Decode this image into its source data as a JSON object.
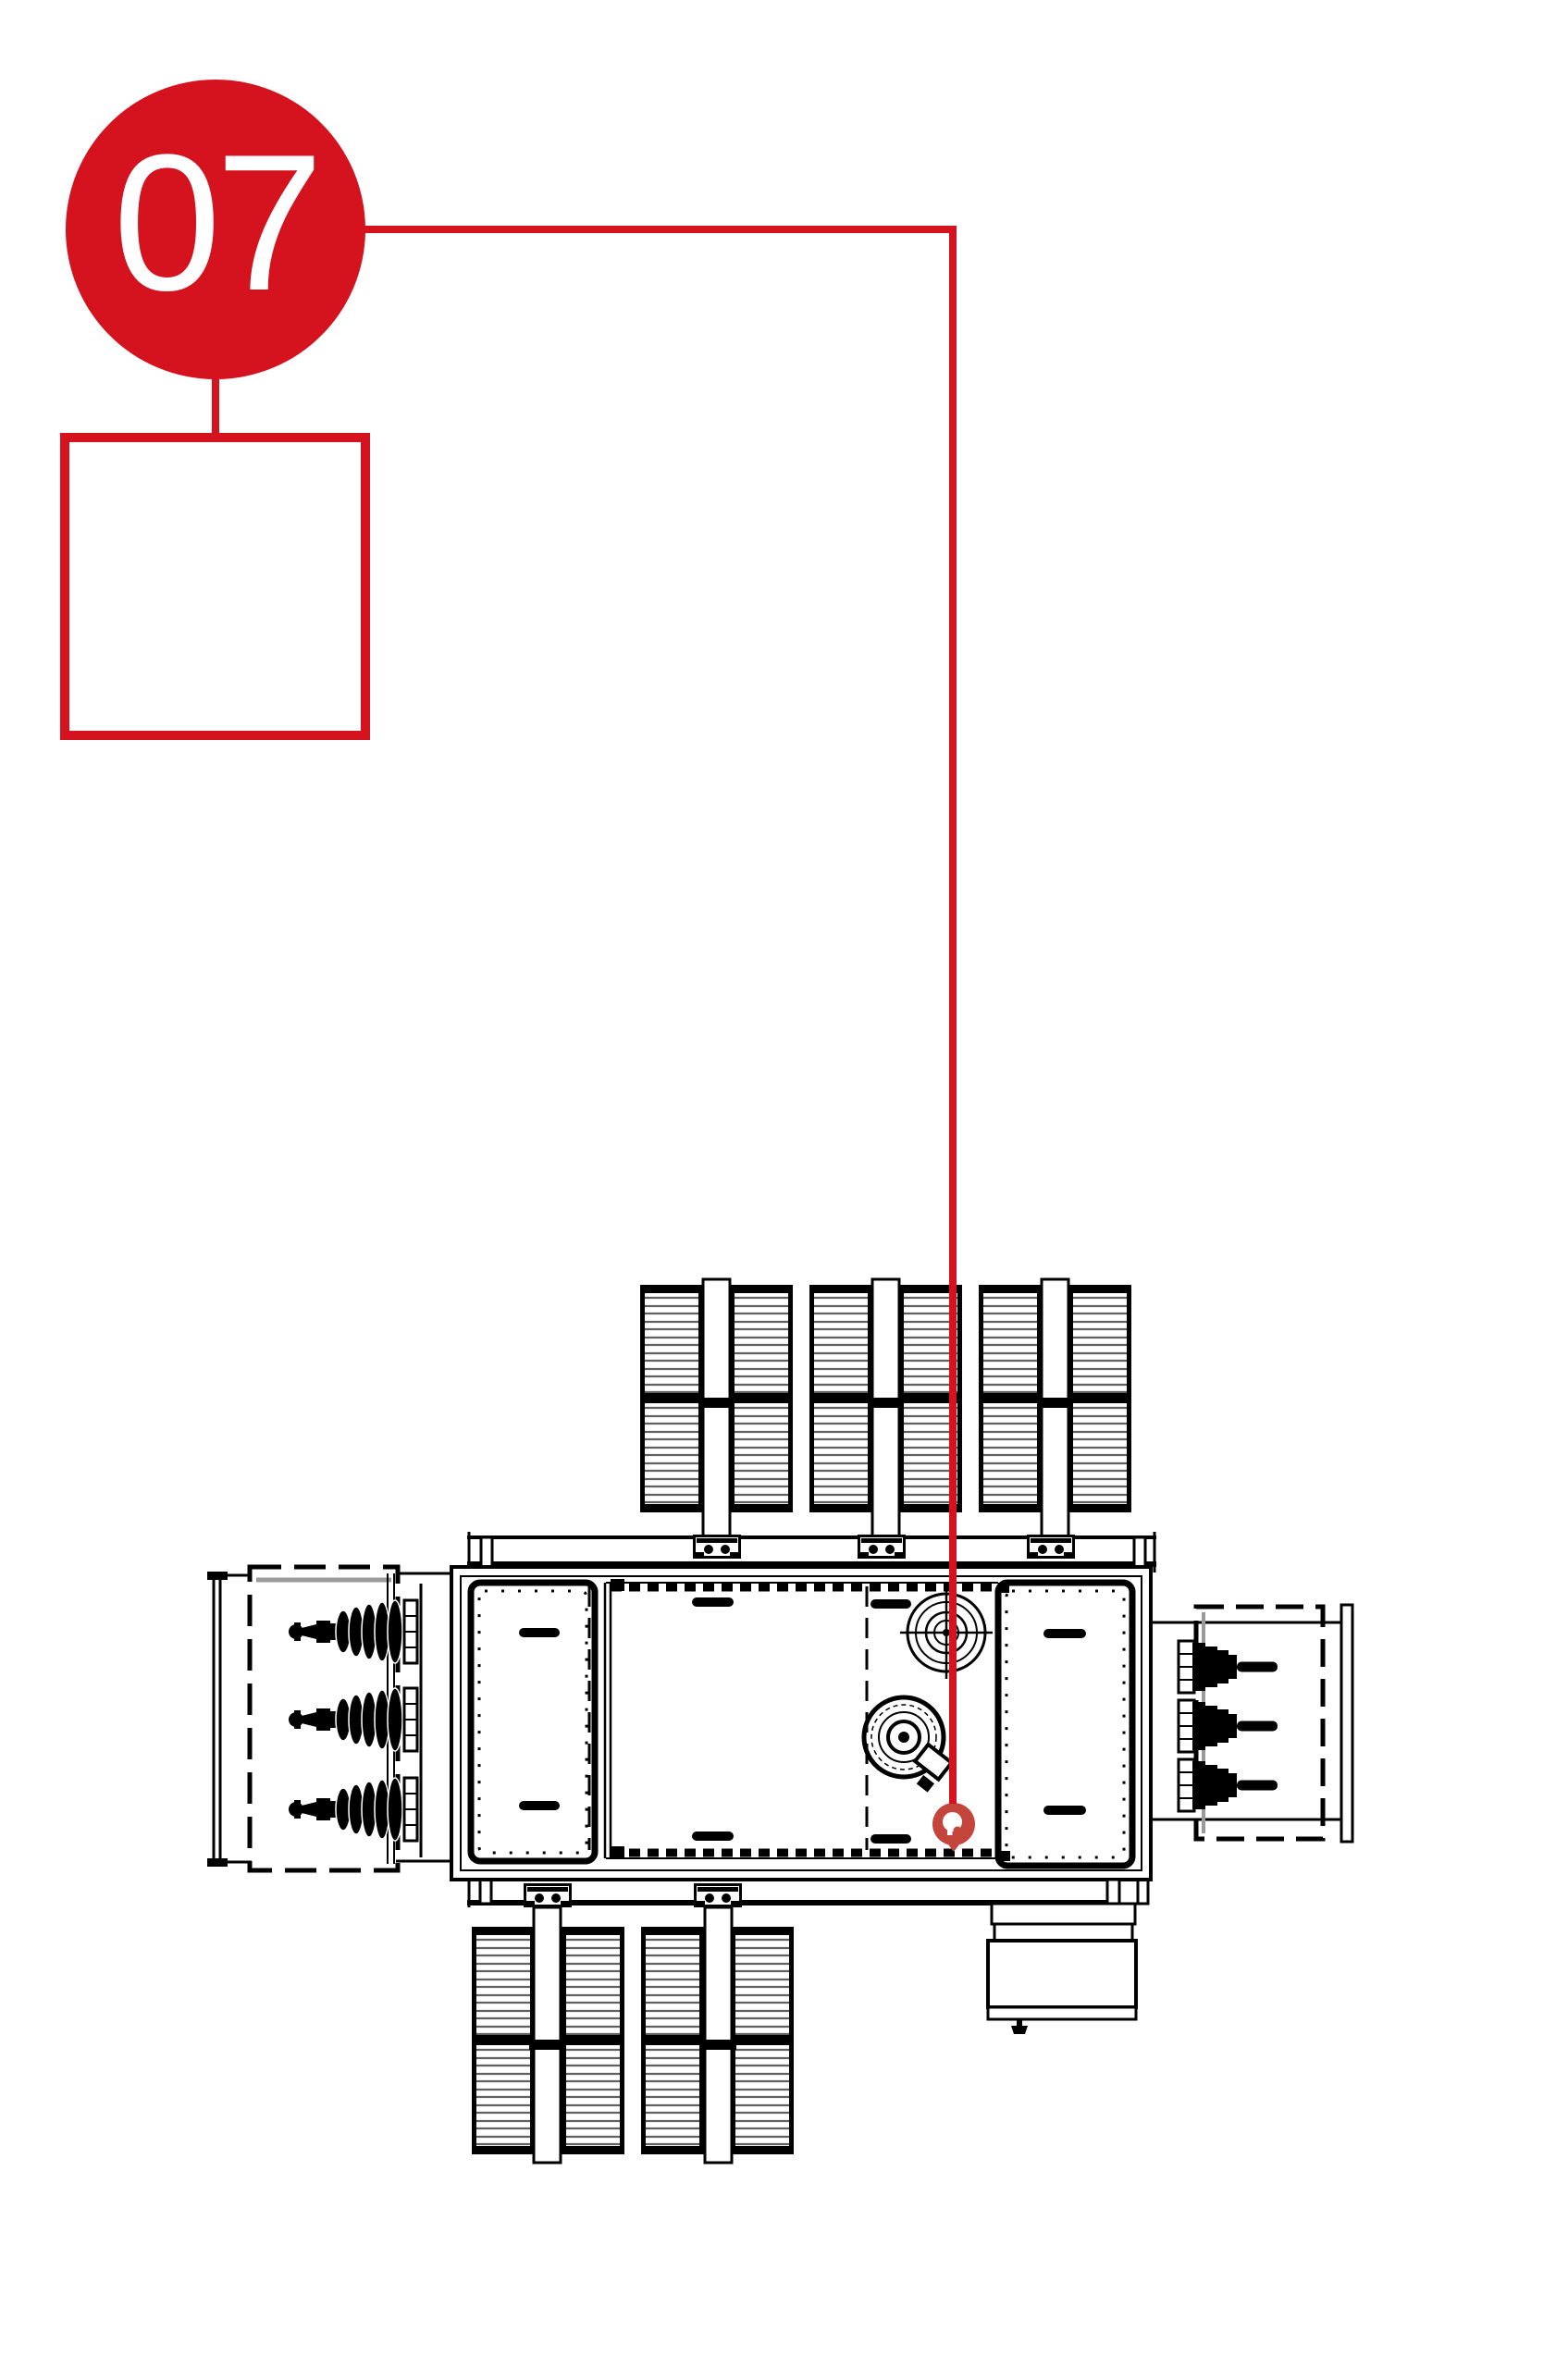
{
  "callout": {
    "number": "07"
  },
  "reference_box": {
    "icon": "location-pin-icon"
  },
  "target_marker": {
    "icon": "location-pin-icon"
  },
  "colors": {
    "accent_red": "#d5131f",
    "marker_red": "#c4453c",
    "drawing_black": "#000000",
    "fin_gray": "#606060",
    "guide_gray": "#9a9a9a"
  }
}
